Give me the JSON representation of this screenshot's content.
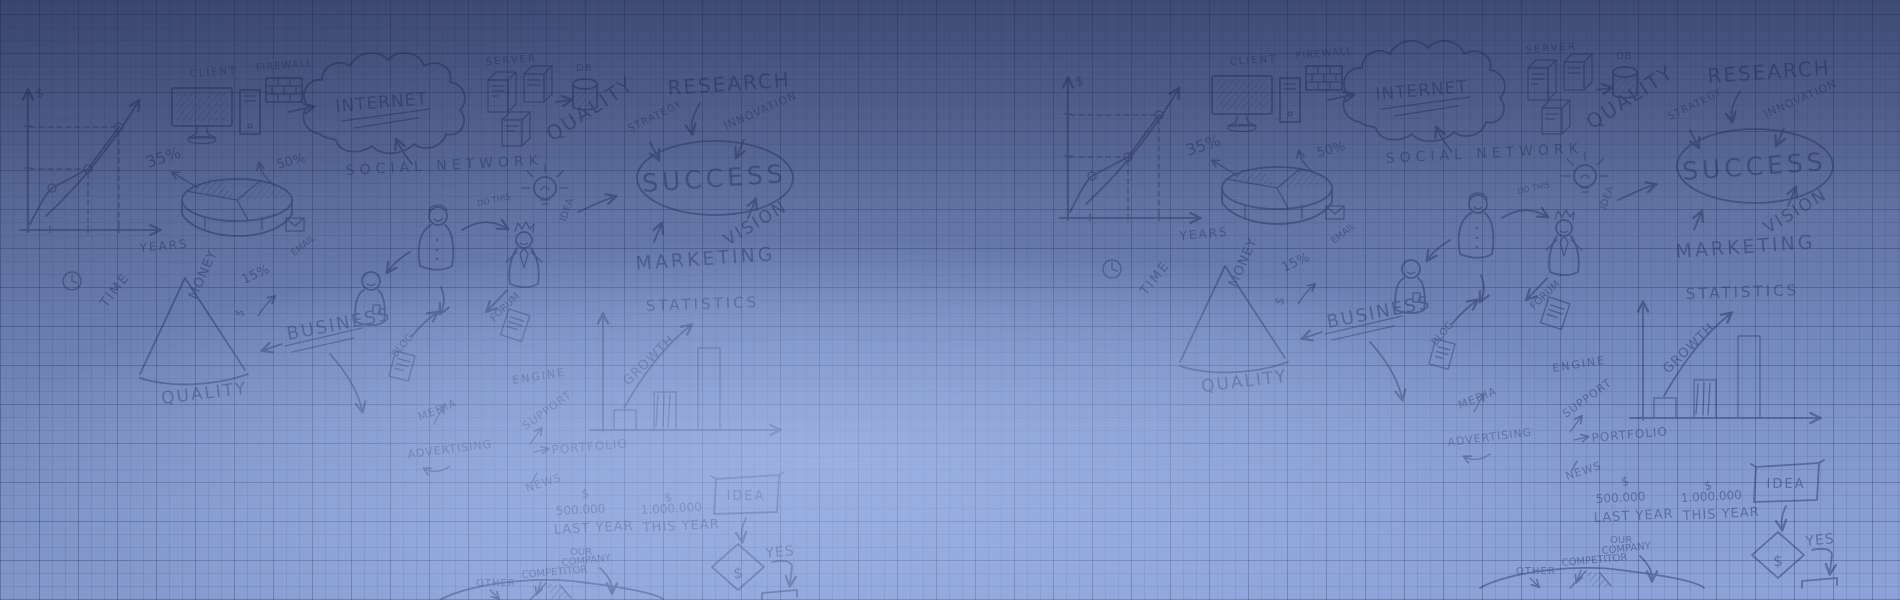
{
  "background": {
    "top_color": "#4c5a88",
    "bottom_color": "#8da3d8",
    "glow_color": "#adc1f0",
    "grid_line_color": "#1e2a54",
    "doodle_ink_color": "#1e2a52"
  },
  "doodles": {
    "labels": {
      "dollar": "$",
      "years": "YEARS",
      "p35": "35%",
      "p50": "50%",
      "p15": "15%",
      "client": "CLIENT",
      "firewall": "FIREWALL",
      "internet": "INTERNET",
      "server": "SERVER",
      "db": "DB",
      "quality": "QUALITY",
      "research": "RESEARCH",
      "innovation": "INNOVATION",
      "strategy": "STRATEGY",
      "success": "SUCCESS",
      "vision": "VISION",
      "marketing": "MARKETING",
      "social_network": "SOCIAL NETWORK",
      "email": "EMAIL",
      "do_this": "DO THIS",
      "idea": "IDEA",
      "time": "TIME",
      "money": "MONEY",
      "business": "BUSINESS",
      "forum": "FORUM",
      "blog": "BLOG",
      "media": "MEDIA",
      "advertising": "ADVERTISING",
      "engine": "ENGINE",
      "support": "SUPPORT",
      "portfolio": "PORTFOLIO",
      "news": "NEWS",
      "statistics": "STATISTICS",
      "growth": "GROWTH",
      "amount_last": "500.000",
      "last_year": "LAST YEAR",
      "amount_this": "1.000.000",
      "this_year": "THIS YEAR",
      "yes": "YES",
      "our": "OUR",
      "company": "COMPANY",
      "competitor": "COMPETITOR",
      "other": "OTHER"
    }
  }
}
